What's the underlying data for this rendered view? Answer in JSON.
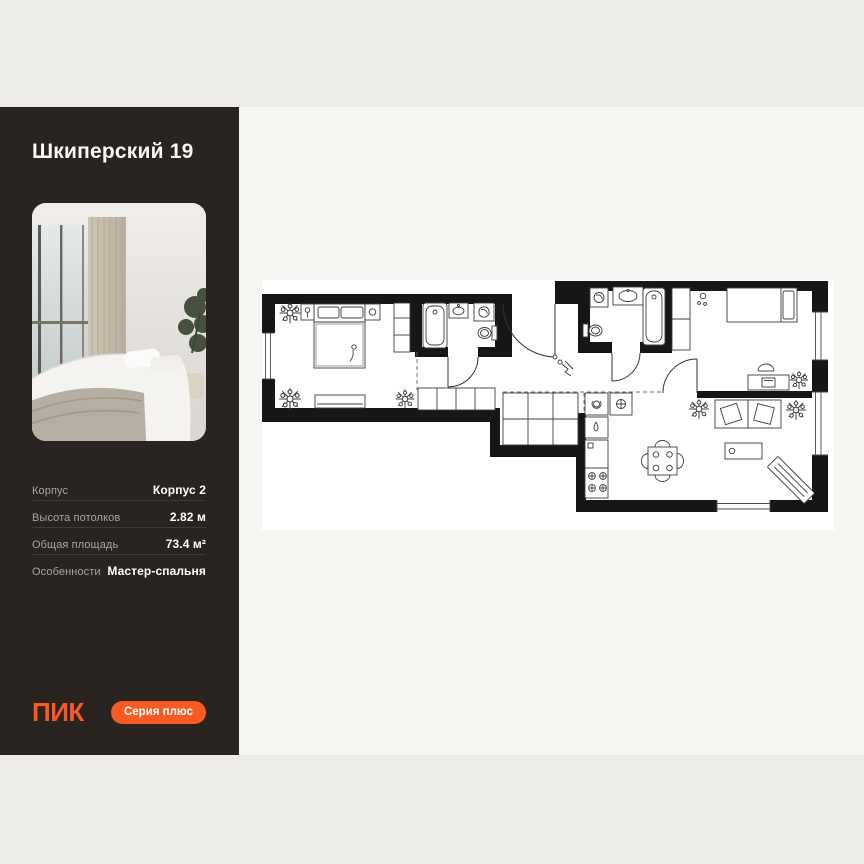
{
  "page": {
    "background": "#ECEBE8"
  },
  "sidebar": {
    "title": "Шкиперский 19",
    "photo": {
      "name": "bedroom-photo"
    },
    "details": [
      {
        "label": "Корпус",
        "value": "Корпус 2"
      },
      {
        "label": "Высота потолков",
        "value": "2.82 м"
      },
      {
        "label": "Общая площадь",
        "value": "73.4 м²"
      },
      {
        "label": "Особенности",
        "value": "Мастер-спальня"
      }
    ],
    "brand_logo": "ПИК",
    "series_button_label": "Серия плюс",
    "colors": {
      "background": "#292420",
      "accent_orange": "#F85A23",
      "label_gray": "#A8A5A1",
      "divider": "#3D3936"
    }
  },
  "floorplan": {
    "name": "apartment-floor-plan",
    "background": "#FFFFFF",
    "wall_color": "#161616",
    "rooms": [
      "bedroom-master",
      "bathroom-1",
      "corridor",
      "hallway",
      "bathroom-2",
      "bedroom-2",
      "kitchen-living-room"
    ]
  }
}
